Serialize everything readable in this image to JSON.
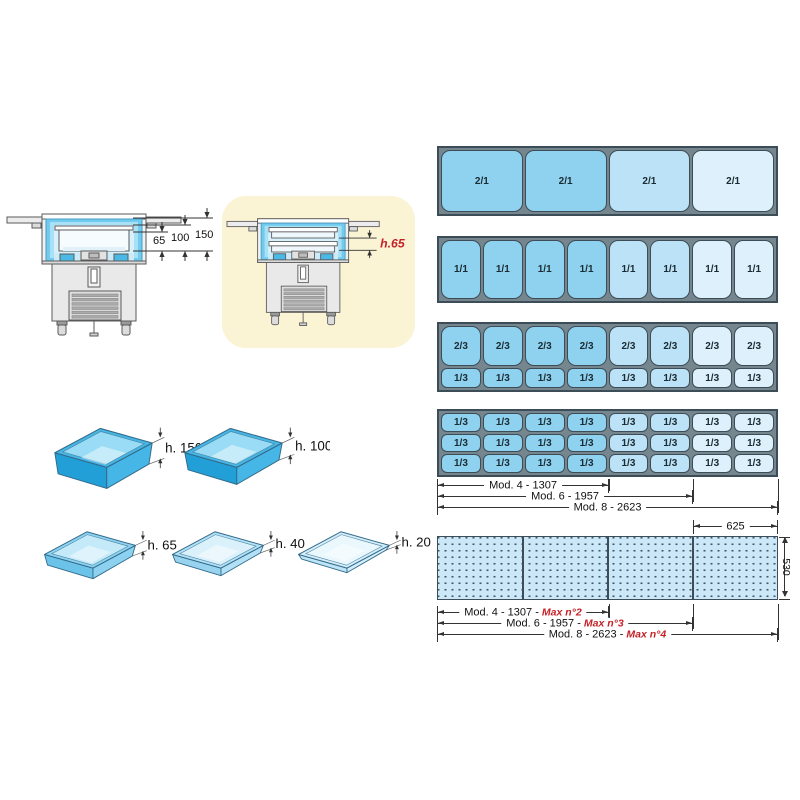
{
  "colors": {
    "mod4_pan": "#8FD2EF",
    "mod6_pan": "#BBE2F6",
    "mod8_pan": "#DDF0FB",
    "frame_border": "#3D4D57",
    "frame_gap": "#76868F",
    "dim_ink": "#333333",
    "accent_red": "#C42127",
    "highlight_yellow": "#FAF3D4",
    "worktop_fill": "#CBE7F8"
  },
  "section_views": {
    "standard": {
      "depth_labels": [
        "65",
        "100",
        "150"
      ]
    },
    "highlighted": {
      "depth_label": "h.65"
    }
  },
  "pan_heights": [
    {
      "label": "h. 150",
      "body": "#45B6E6",
      "side": "#229FD6",
      "interior": "#9ADCF5"
    },
    {
      "label": "h. 100",
      "body": "#45B6E6",
      "side": "#229FD6",
      "interior": "#9ADCF5"
    },
    {
      "label": "h. 65",
      "body": "#8CD2F0",
      "side": "#6CC3E9",
      "interior": "#C4E9F9"
    },
    {
      "label": "h. 40",
      "body": "#B2E0F6",
      "side": "#98D4F0",
      "interior": "#DAF1FB"
    },
    {
      "label": "h. 20",
      "body": "#D3EDFA",
      "side": "#BEE5F7",
      "interior": "#EAF7FD"
    }
  ],
  "gn_layouts": [
    {
      "bands": [
        "2/1"
      ],
      "columns": 4,
      "color_map": [
        0,
        0,
        1,
        2
      ]
    },
    {
      "bands": [
        "1/1"
      ],
      "columns": 8,
      "color_map": [
        0,
        0,
        0,
        0,
        1,
        1,
        2,
        2
      ]
    },
    {
      "bands": [
        "2/3",
        "1/3"
      ],
      "columns": 8,
      "color_map": [
        0,
        0,
        0,
        0,
        1,
        1,
        2,
        2
      ]
    },
    {
      "bands": [
        "1/3",
        "1/3",
        "1/3"
      ],
      "columns": 8,
      "color_map": [
        0,
        0,
        0,
        0,
        1,
        1,
        2,
        2
      ]
    }
  ],
  "module_dimensions": [
    {
      "label": "Mod. 4 - 1307"
    },
    {
      "label": "Mod. 6 - 1957"
    },
    {
      "label": "Mod. 8 - 2623"
    }
  ],
  "worktop": {
    "section_width": "625",
    "depth": "530"
  },
  "worktop_dimensions": [
    {
      "label": "Mod. 4 - 1307 -",
      "max": "Max n°2"
    },
    {
      "label": "Mod. 6 - 1957 -",
      "max": "Max n°3"
    },
    {
      "label": "Mod. 8 - 2623 -",
      "max": "Max n°4"
    }
  ]
}
